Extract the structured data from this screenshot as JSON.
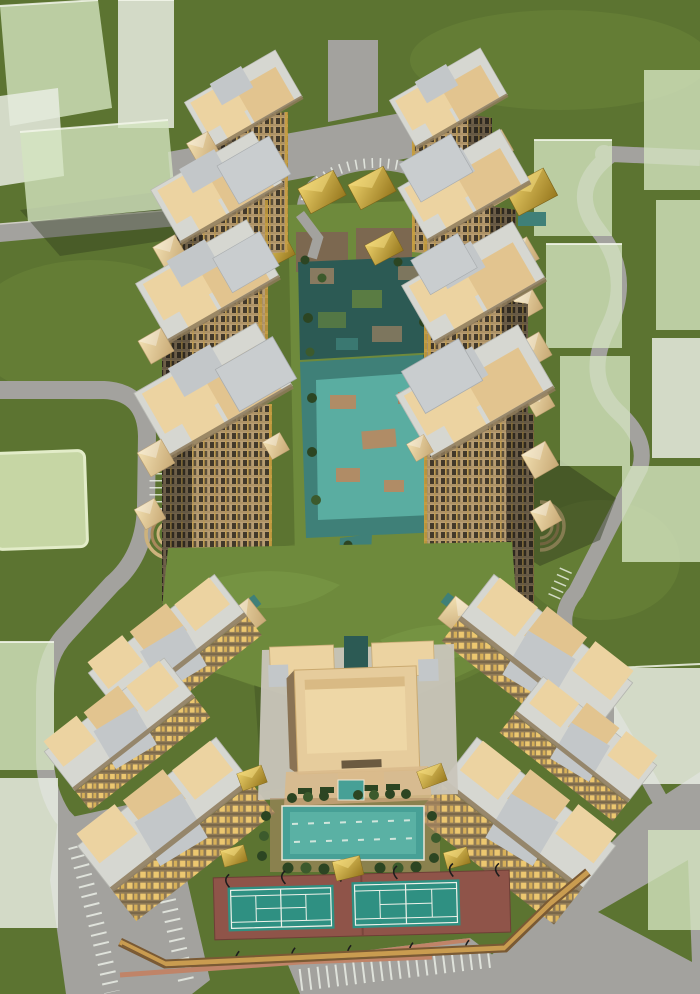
{
  "scene": {
    "title": "Residential complex — aerial architectural rendering",
    "description": "Bird's-eye 3D rendering of a gated residential development: eight beige high-rise towers flanking a central water-garden courtyard with gold pavilions, a semicircular entry drop-off at the north, mid-rise wings in a V around a clubhouse, swimming pool and two tennis courts at the south, perimeter roads with parking, two small amphitheatres, and translucent pale-green context massing blocks around the site.",
    "view": "aerial three-quarter bird's-eye",
    "style": "3D architectural visualization, no text labels"
  },
  "elements": {
    "high_rise_towers": 8,
    "mid_rise_blocks": 6,
    "gold_pavilions": 11,
    "tennis_courts": 2,
    "swimming_pools": 2,
    "amphitheatres": 2,
    "entry_plaza": "T-shaped plaza with semicircular parking arc",
    "water_features": [
      "central canal garden",
      "reflecting pool",
      "south stream",
      "leisure pool"
    ],
    "context": "translucent green massing blocks and perimeter roads"
  },
  "palette": {
    "grass": "#5c7431",
    "grass_light": "#6e8a3c",
    "grass_pale": "#c6d6a4",
    "road": "#a3a29e",
    "curb": "#cfcdc4",
    "path_pink": "#c08468",
    "line_white": "#eef2ea",
    "mass_green": "#d3e4bf",
    "mass_white": "#e7ece2",
    "mass_edge": "#f2f6ea",
    "shadow": "#2e3a1c",
    "roof_deck": "#d6d7d1",
    "roof_beige": "#ecd3a1",
    "roof_beige2": "#e2c48f",
    "roof_gray": "#c3c7c9",
    "roof_edge": "#8d7a5a",
    "roof_line": "#b5b6b0",
    "facade_lit": "#b89d72",
    "window_dark": "#42392a",
    "window_dark2": "#5c4f3a",
    "facade_floor": "#a68b5f",
    "gold": "#c79f3e",
    "facade_shade": "#6e5f48",
    "window_shade": "#2f2920",
    "gold_shade": "#8a6f2c",
    "facade_floor_shade": "#5f5340",
    "mid_wall": "#8f7a56",
    "mid_win": "#ecc770",
    "mid_win2": "#d8b159",
    "mid_floor": "#7a684a",
    "water": "#3f8078",
    "water_dark": "#2c5a54",
    "pool": "#47a096",
    "pool_light": "#5fb5a8",
    "deck_tan": "#b08c66",
    "paving": "#a08263",
    "paving_dark": "#7c6850",
    "tree": "#2c4522",
    "tree_light": "#3c5a2c",
    "club": "#e6cc9c",
    "club_light": "#eed7a6",
    "club_dark": "#8a7354",
    "court_red": "#8f5449",
    "court_teal": "#2f9082",
    "pole": "#1d1d1d",
    "wall_brown": "#7a5a34",
    "wall_gold": "#c99c50",
    "gold_light": "#ecd06a",
    "gold_dark": "#97781e",
    "hip_light": "#f2e0b2",
    "hip_dark": "#c8a975"
  }
}
